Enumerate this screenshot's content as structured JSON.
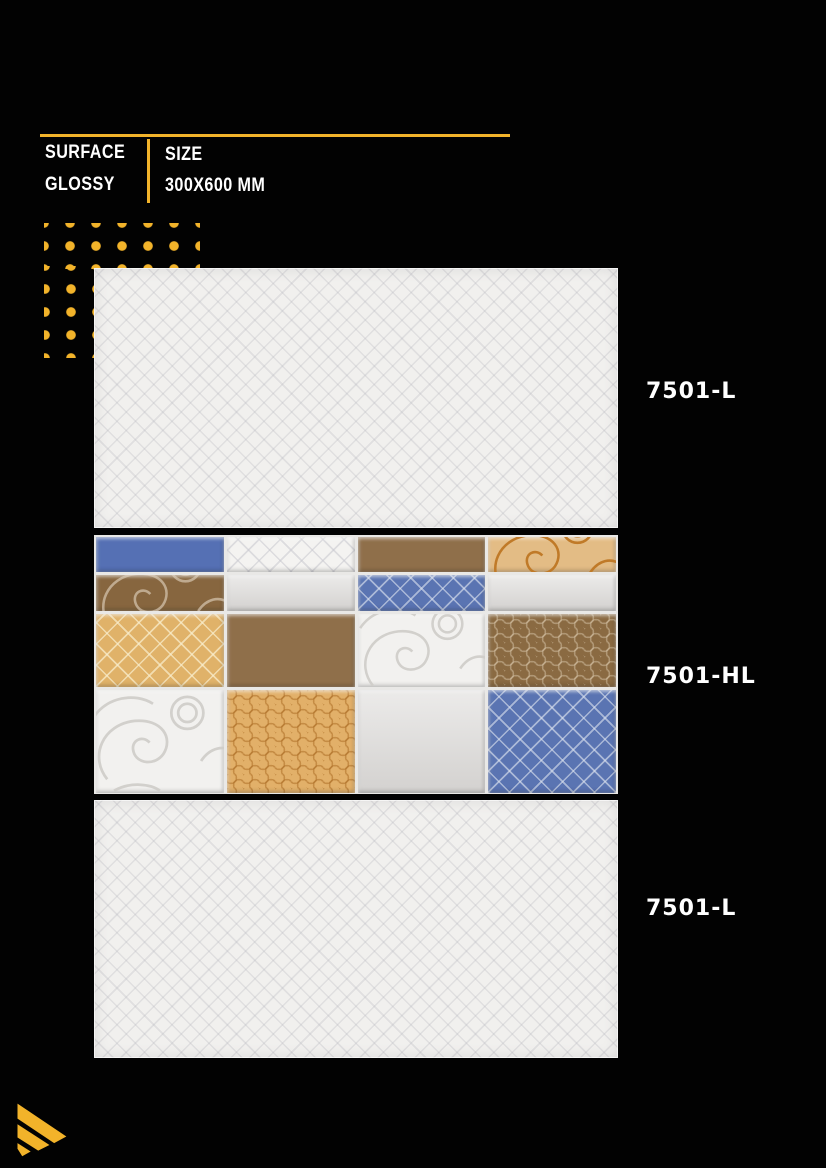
{
  "header": {
    "surface_label": "SURFACE",
    "surface_value": "GLOSSY",
    "size_label": "SIZE",
    "size_value": "300X600 MM"
  },
  "products": [
    {
      "code": "7501-L",
      "description": "glossy plain light wall tile"
    },
    {
      "code": "7501-HL",
      "description": "glossy highlighter patchwork wall tile"
    },
    {
      "code": "7501-L",
      "description": "glossy plain light wall tile"
    }
  ],
  "highlighter_grid": {
    "row_heights": [
      35,
      36,
      73,
      103
    ],
    "rows": [
      [
        "blue-solid",
        "white-lattice",
        "brown-solid",
        "gold-paisley"
      ],
      [
        "brown-paisley",
        "grey-solid",
        "blue-lattice",
        "grey-solid"
      ],
      [
        "gold-lattice",
        "brown-solid",
        "white-paisley",
        "brown-honeycomb"
      ],
      [
        "white-paisley",
        "gold-honeycomb",
        "grey-solid",
        "blue-lattice"
      ]
    ]
  },
  "colors": {
    "background": "#020202",
    "accent_yellow": "#F2B32A",
    "blue": "#5570B4",
    "brown": "#8F6F4A",
    "gold": "#E0B269",
    "grey": "#DCDAD8",
    "white_tile": "#F1F0EE",
    "label_text": "#FFFFFF"
  }
}
